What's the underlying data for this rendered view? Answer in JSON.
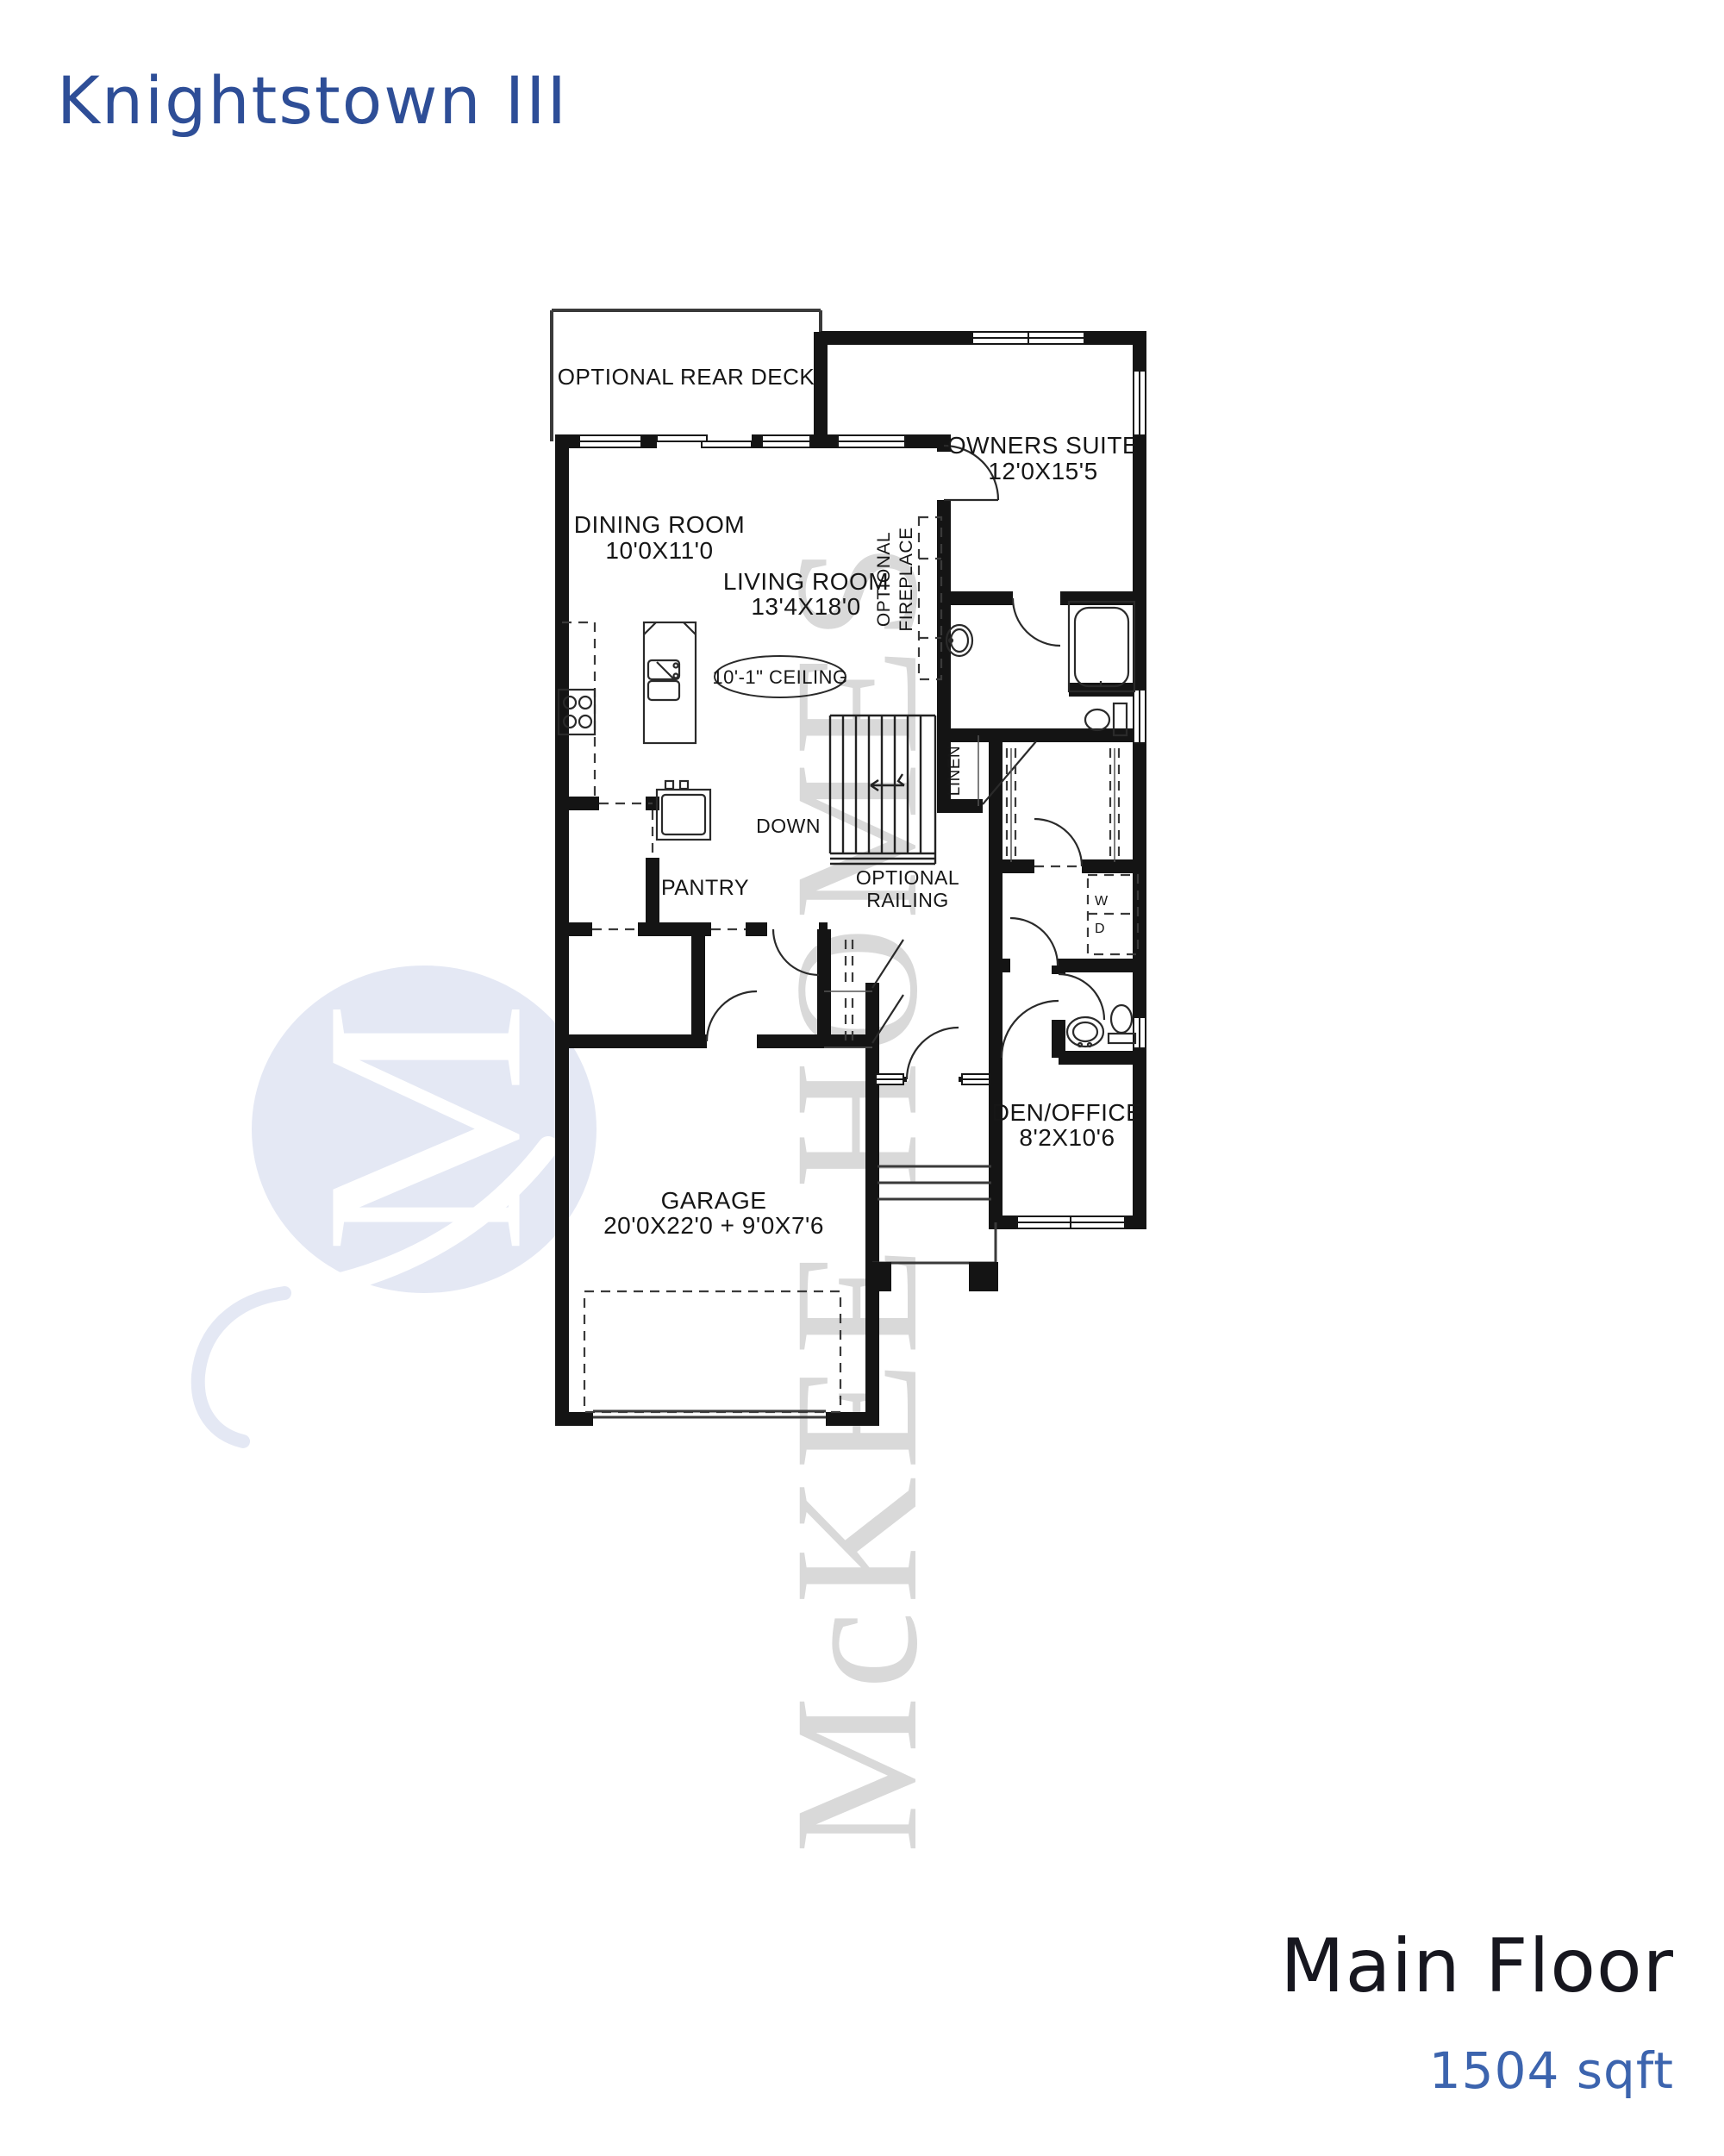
{
  "document": {
    "title": "Knightstown III",
    "floor_name": "Main Floor",
    "floor_area": "1504 sqft"
  },
  "watermark": {
    "text": "McKEE HOMES",
    "logo_letter": "M"
  },
  "colors": {
    "title_blue": "#2e4e97",
    "footer_ink": "#17171f",
    "area_blue": "#3c64ae",
    "wall_black": "#141414",
    "watermark_gray": "#d9d9d9",
    "logo_blue": "#e4e8f4"
  },
  "rooms": {
    "deck": {
      "name": "OPTIONAL REAR DECK"
    },
    "owners": {
      "name": "OWNERS SUITE",
      "dims": "12'0X15'5"
    },
    "dining": {
      "name": "DINING ROOM",
      "dims": "10'0X11'0"
    },
    "living": {
      "name": "LIVING ROOM",
      "dims": "13'4X18'0"
    },
    "den": {
      "name": "DEN/OFFICE",
      "dims": "8'2X10'6"
    },
    "garage": {
      "name": "GARAGE",
      "dims": "20'0X22'0 + 9'0X7'6"
    },
    "pantry": {
      "name": "PANTRY"
    },
    "linen": {
      "name": "LINEN"
    }
  },
  "notes": {
    "ceiling": "10'-1\" CEILING",
    "fireplace_line1": "OPTIONAL",
    "fireplace_line2": "FIREPLACE",
    "stairs": "DOWN",
    "railing_line1": "OPTIONAL",
    "railing_line2": "RAILING",
    "washer": "W",
    "dryer": "D"
  }
}
